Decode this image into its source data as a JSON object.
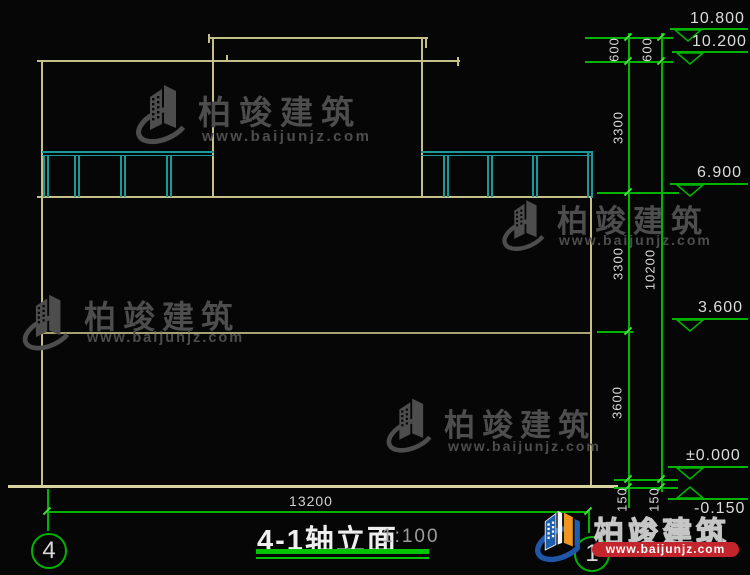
{
  "drawing": {
    "title": "4-1轴立面",
    "scale": "1:100",
    "axis": {
      "left_bubble": "4",
      "right_bubble": "1"
    },
    "dims": {
      "d600a": "600",
      "d600b": "600",
      "d3300a": "3300",
      "d3300b": "3300",
      "d3600": "3600",
      "d10200": "10200",
      "d150a": "150",
      "d150b": "150",
      "d13200": "13200"
    },
    "elev": {
      "e10800": "10.800",
      "e10200": "10.200",
      "e6900": "6.900",
      "e3600": "3.600",
      "e0": "±0.000",
      "eneg": "-0.150"
    }
  },
  "watermark": {
    "name": "柏竣建筑",
    "url": "www.baijunjz.com"
  },
  "colors": {
    "background": "#060606",
    "building_line": "#C5BF88",
    "ground_line": "#D8D2A0",
    "railing": "#169A9A",
    "dimension_green": "#00B400",
    "tick_green": "#43DF3C",
    "dim_text": "#D9D9D9",
    "title_text": "#EFEFEF",
    "underline_green": "#00C400",
    "watermark_gray": "#4D4D4D",
    "logo_blue": "#1D5FAC",
    "logo_orange": "#F0951F",
    "logo_red": "#C4242B"
  }
}
